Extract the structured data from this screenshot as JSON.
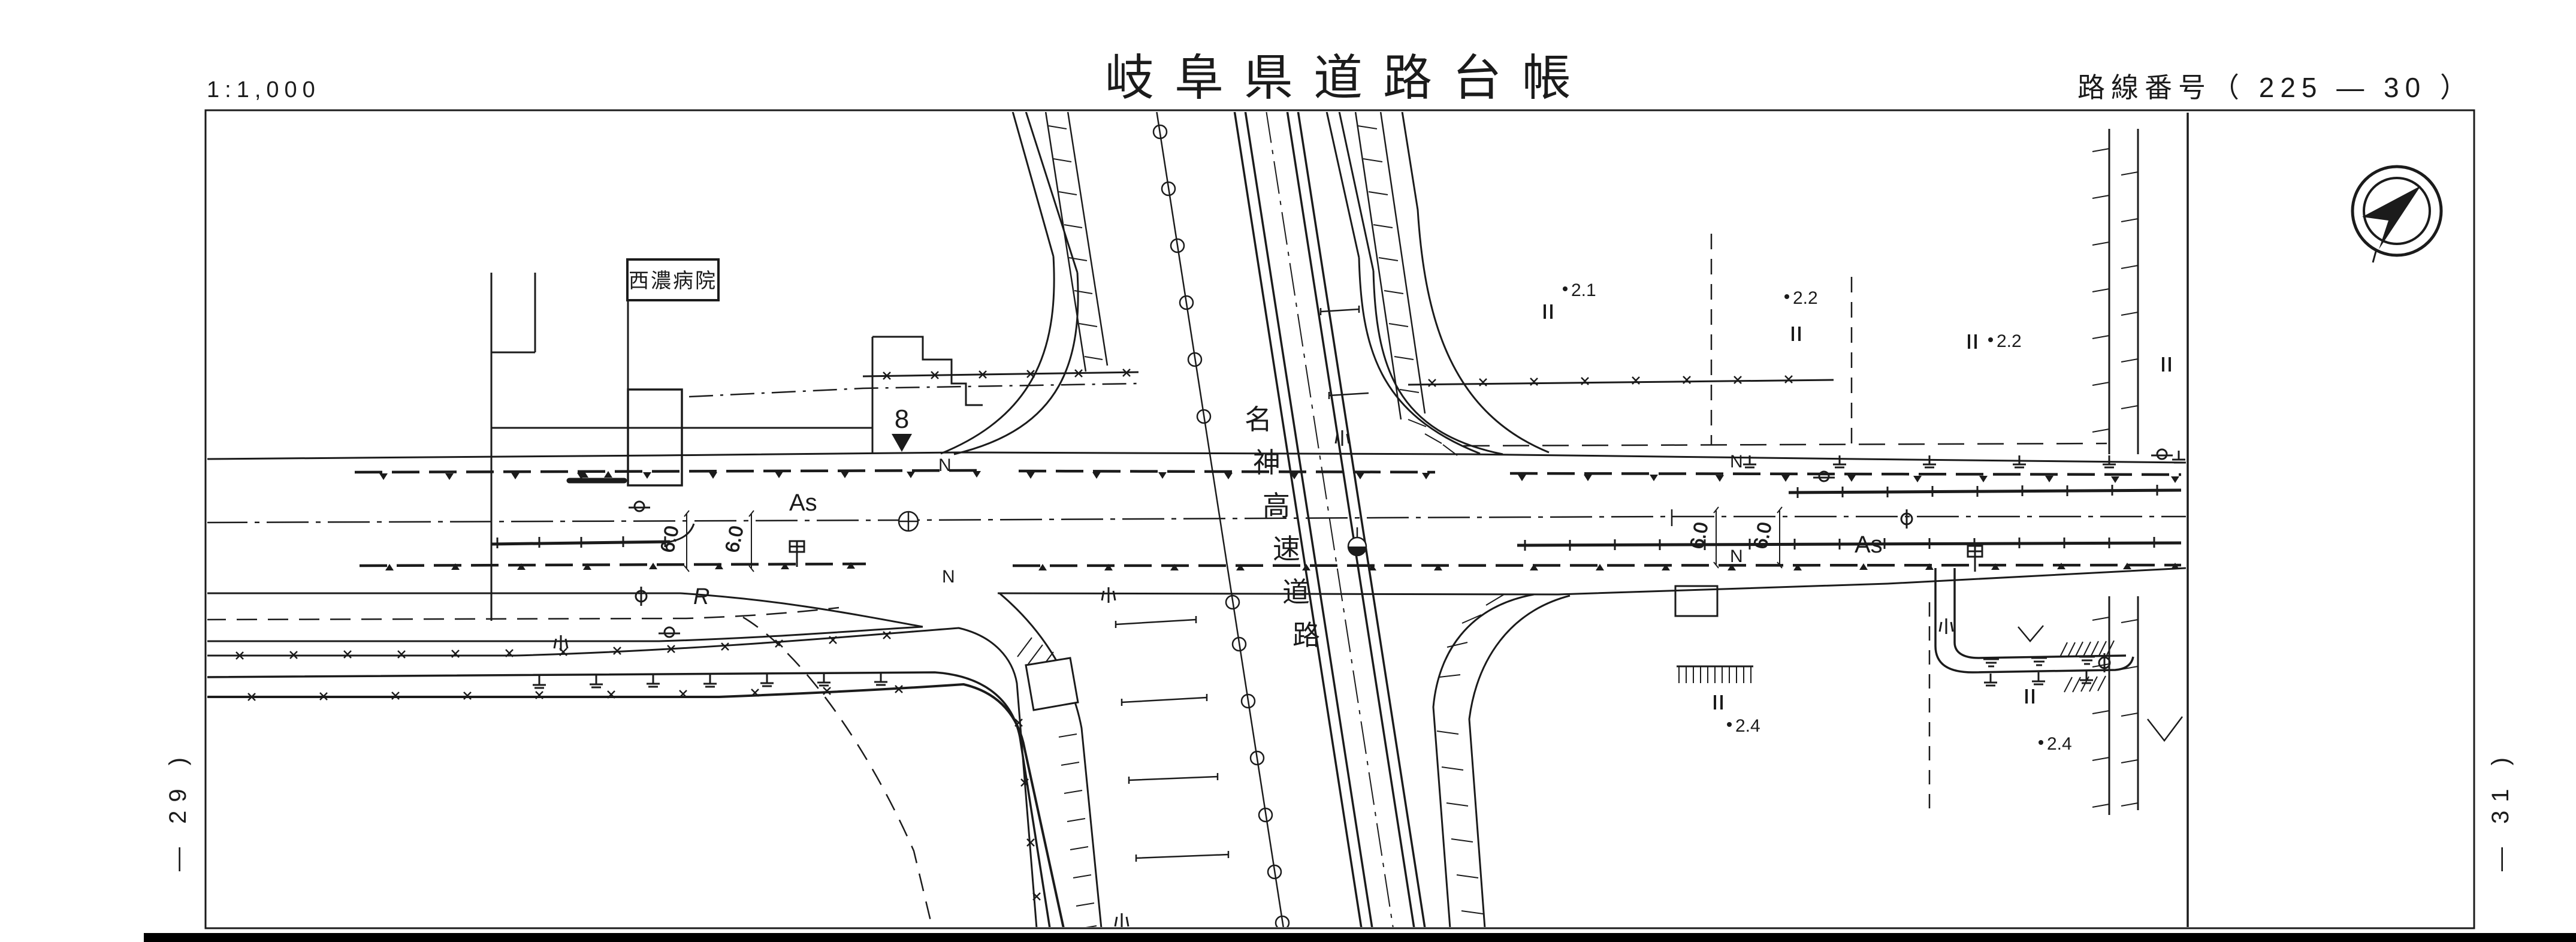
{
  "header": {
    "scale_label": "1:1,000",
    "title": "岐阜県道路台帳",
    "route_label": "路線番号（ 225 — 30 ）"
  },
  "sheet_links": {
    "left": "— 29 )",
    "right": "— 31 )"
  },
  "map": {
    "hospital_label": "西濃病院",
    "expressway_name": "名神高速道路",
    "expressway_chars": [
      "名",
      "神",
      "高",
      "速",
      "道",
      "路"
    ],
    "surface_labels": {
      "west": "As",
      "east": "As"
    },
    "lane_labels": [
      "N",
      "N",
      "N",
      "N"
    ],
    "width_labels": [
      "6.0",
      "6.0",
      "6.0",
      "6.0"
    ],
    "station_number": "8",
    "curve_label": "R",
    "spot_elevations": [
      "2.1",
      "2.2",
      "2.2",
      "2.4",
      "2.4"
    ]
  },
  "colors": {
    "ink": "#1b1b1b",
    "paper": "#ffffff"
  }
}
